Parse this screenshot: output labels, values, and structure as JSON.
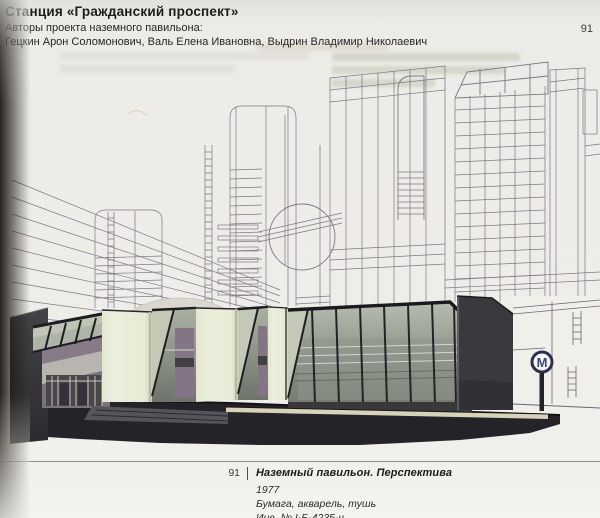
{
  "header": {
    "title": "Станция «Гражданский проспект»",
    "subtitle": "Авторы проекта наземного павильона:",
    "authors": "Гецкин Арон Соломонович, Валь Елена Ивановна, Выдрин Владимир Николаевич",
    "page_number": "91"
  },
  "caption": {
    "figure_number": "91",
    "title": "Наземный павильон. Перспектива",
    "year": "1977",
    "medium": "Бумага, акварель, тушь",
    "inventory": "Инв. № I-Б-4235-ч"
  },
  "artwork": {
    "metro_logo_letter": "М",
    "colors": {
      "paper": "#efede9",
      "ink_text": "#232323",
      "drawing_line": "#6b6473",
      "pavilion_pale": "#e9ecd8",
      "glass_green": "#9aa094",
      "interior_mauve": "#837586",
      "charcoal": "#3a393d",
      "ground_dark": "#242328",
      "platform_tan": "#d7d3b8",
      "metro_navy": "#2a2f4e",
      "metro_blue": "#3a467d"
    }
  }
}
